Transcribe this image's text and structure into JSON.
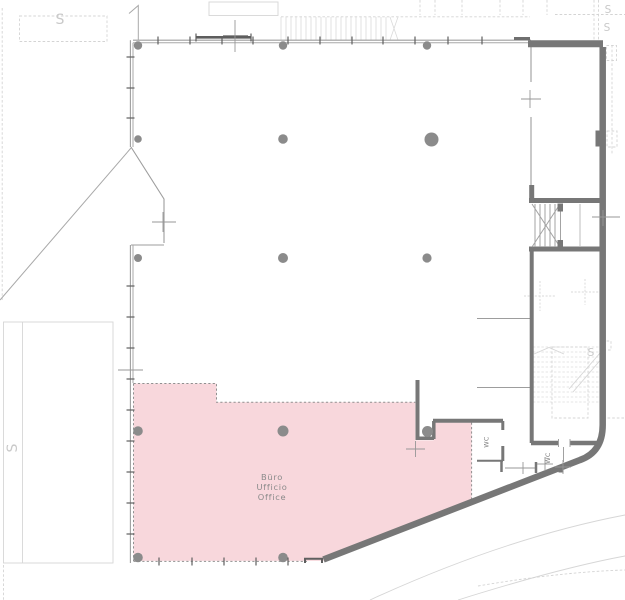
{
  "office_room": {
    "line1": "Büro",
    "line2": "Ufficio",
    "line3": "Office"
  },
  "wc_rooms": {
    "wc1": "WC",
    "wc2": "WC"
  },
  "section_marker": "S",
  "colors": {
    "highlight_fill": "#f8d7dc",
    "highlight_border": "#909090",
    "wall_dark": "#777777",
    "wall_light": "#9d9d9d",
    "site_line": "#d6d6d6",
    "column": "#8b8b8b",
    "label_text": "#8a8a8a",
    "background": "#ffffff"
  }
}
